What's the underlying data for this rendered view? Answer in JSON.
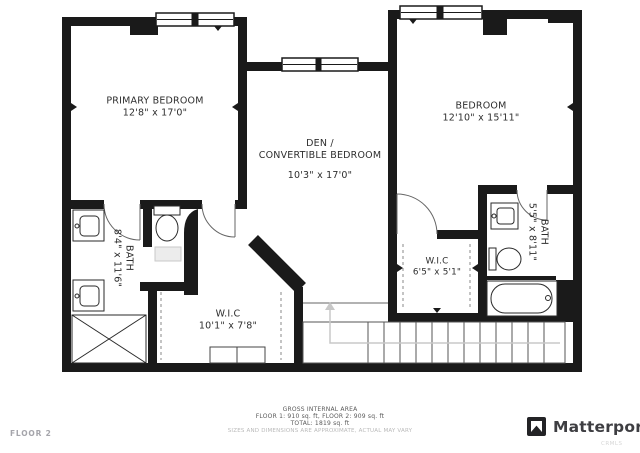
{
  "floor_label": "FLOOR 2",
  "rooms": {
    "primary_bedroom": {
      "name": "PRIMARY BEDROOM",
      "dims": "12'8\" x 17'0\""
    },
    "den": {
      "name_line1": "DEN /",
      "name_line2": "CONVERTIBLE BEDROOM",
      "dims": "10'3\" x 17'0\""
    },
    "bedroom": {
      "name": "BEDROOM",
      "dims": "12'10\" x 15'11\""
    },
    "bath_left": {
      "name": "BATH",
      "dims": "8'4\" x 11'6\""
    },
    "wic_left": {
      "name": "W.I.C",
      "dims": "10'1\" x 7'8\""
    },
    "wic_right": {
      "name": "W.I.C",
      "dims": "6'5\" x 5'1\""
    },
    "bath_right": {
      "name": "BATH",
      "dims": "5'5\" x 8'11\""
    }
  },
  "footer": {
    "title": "GROSS INTERNAL AREA",
    "line1": "FLOOR 1: 910 sq. ft, FLOOR 2: 909 sq. ft",
    "line2": "TOTAL: 1819 sq. ft",
    "disclaimer": "SIZES AND DIMENSIONS ARE APPROXIMATE, ACTUAL MAY VARY"
  },
  "branding": {
    "logo_text": "Matterport",
    "watermark": "CRMLS"
  },
  "colors": {
    "wall": "#1a1a1a",
    "line": "#555555",
    "fixture": "#2a2a2a",
    "walkline": "#c8c8c8"
  }
}
